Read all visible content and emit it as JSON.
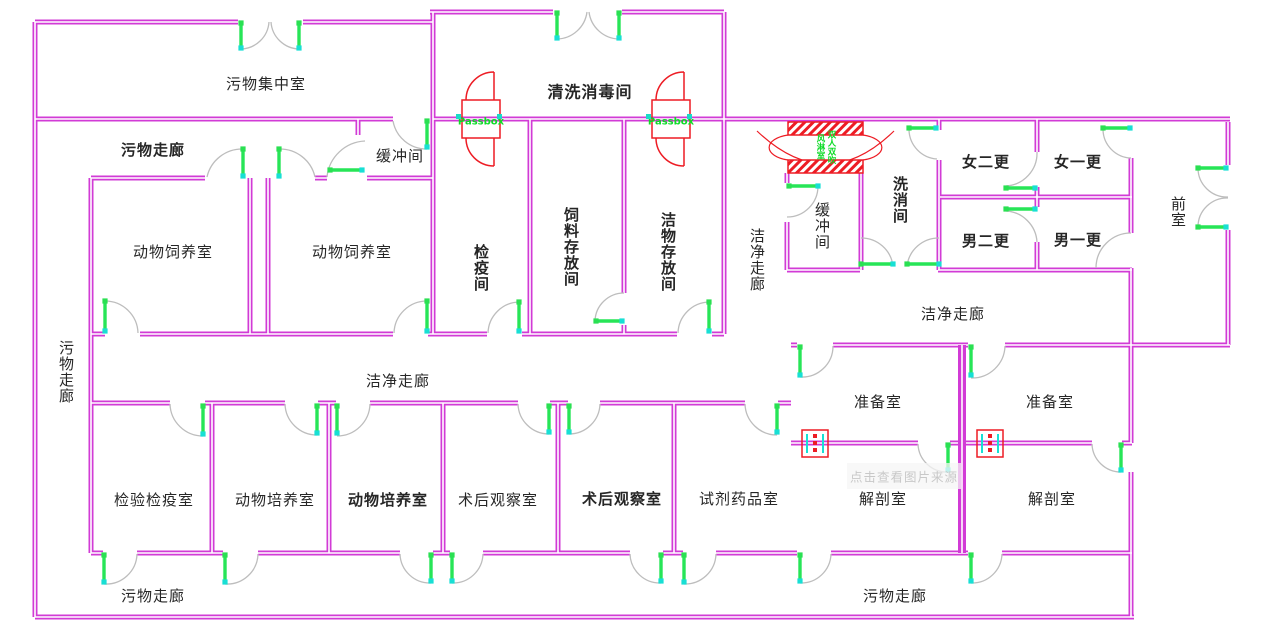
{
  "title": "实验动物房平面图",
  "labels": {
    "waste_collection_room": "污物集中室",
    "dirty_corridor_top": "污物走廊",
    "buffer_room_topleft": "缓冲间",
    "cleaning_disinfection_room": "清洗消毒间",
    "animal_breeding_room_1": "动物饲养室",
    "animal_breeding_room_2": "动物饲养室",
    "quarantine_room": "检疫间",
    "feed_storage_room": "饲料存放间",
    "clean_goods_storage_room": "洁物存放间",
    "clean_corridor_vertical": "洁净走廊",
    "buffer_room_right": "缓冲间",
    "washing_room": "洗消间",
    "female_second_change": "女二更",
    "female_first_change": "女一更",
    "male_second_change": "男二更",
    "male_first_change": "男一更",
    "anteroom": "前室",
    "clean_corridor_right": "洁净走廊",
    "clean_corridor_left": "洁净走廊",
    "dirty_corridor_left_vertical": "污物走廊",
    "prep_room_1": "准备室",
    "prep_room_2": "准备室",
    "inspection_quarantine_room": "检验检疫室",
    "animal_culture_room_1": "动物培养室",
    "animal_culture_room_2": "动物培养室",
    "postop_observation_room_1": "术后观察室",
    "postop_observation_room_2": "术后观察室",
    "reagent_medicine_room": "试剂药品室",
    "dissection_room_1": "解剖室",
    "dissection_room_2": "解剖室",
    "dirty_corridor_bottom_1": "污物走廊",
    "dirty_corridor_bottom_2": "污物走廊"
  },
  "passbox": {
    "label": "Passbox"
  },
  "air_shower": {
    "label_right": "双人双吹",
    "label_left": "风淋室"
  },
  "watermark": {
    "text": "点击查看图片来源"
  },
  "colors": {
    "wall": "#d23bd6",
    "arc": "#bdbdbd",
    "leaf": "#27e557",
    "dot": "#1adbc8",
    "red": "#ed1c24",
    "passbox_text": "#0ddb27",
    "label": "#262626",
    "watermark": "#c8c8c8"
  }
}
